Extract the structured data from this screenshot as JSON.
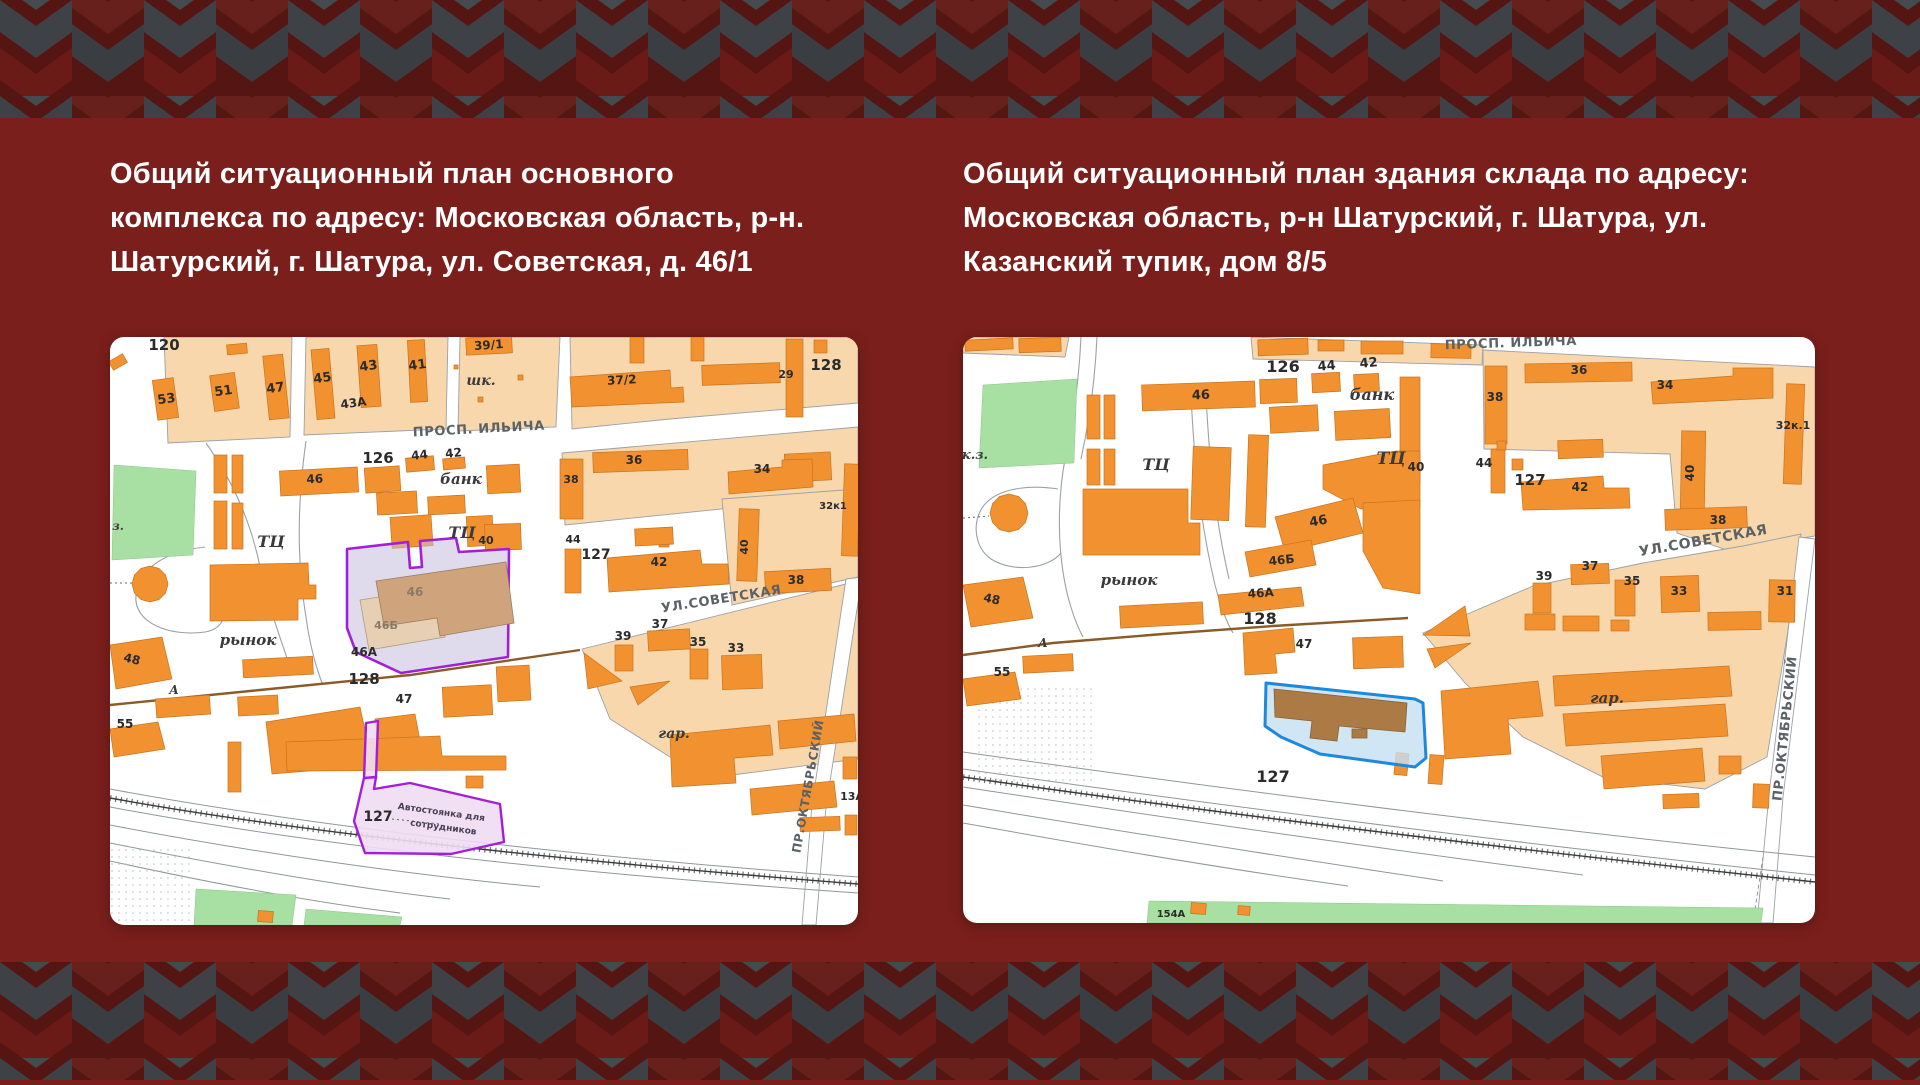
{
  "palette": {
    "page_background": "#7A1F1B",
    "pattern_charcoal": "#3E4247",
    "pattern_dark_red": "#551512",
    "title_color": "#FFFFFF",
    "map_block": "#F8D7AC",
    "map_building": "#F2912F",
    "map_green": "#A7E0A2",
    "highlight_purple": "#A21FD9",
    "highlight_blue": "#1E88DD"
  },
  "left_panel": {
    "title_lines": {
      "0": "Общий ситуационный план основного",
      "1": "комплекса по адресу: Московская область, р-н.",
      "2": "Шатурский, г. Шатура, ул. Советская, д. 46/1"
    },
    "map": {
      "labels": [
        {
          "t": "120",
          "x": 54,
          "y": 13,
          "fs": 15
        },
        {
          "t": "53",
          "x": 57,
          "y": 66,
          "fs": 13,
          "rot": -8
        },
        {
          "t": "51",
          "x": 114,
          "y": 58,
          "fs": 13,
          "rot": -8
        },
        {
          "t": "47",
          "x": 166,
          "y": 55,
          "fs": 13,
          "rot": -8
        },
        {
          "t": "45",
          "x": 213,
          "y": 45,
          "fs": 13,
          "rot": -8
        },
        {
          "t": "43",
          "x": 259,
          "y": 33,
          "fs": 13,
          "rot": -8
        },
        {
          "t": "43А",
          "x": 244,
          "y": 70,
          "fs": 12,
          "rot": -8
        },
        {
          "t": "41",
          "x": 308,
          "y": 32,
          "fs": 13,
          "rot": -8
        },
        {
          "t": "39/1",
          "x": 379,
          "y": 12,
          "fs": 12,
          "rot": -4
        },
        {
          "t": "шк.",
          "x": 371,
          "y": 48,
          "fs": 14,
          "c": "name"
        },
        {
          "t": "37/2",
          "x": 512,
          "y": 47,
          "fs": 12,
          "rot": -3
        },
        {
          "t": "29",
          "x": 676,
          "y": 41,
          "fs": 11
        },
        {
          "t": "128",
          "x": 716,
          "y": 33,
          "fs": 15
        },
        {
          "t": "ПРОСП. ИЛЬИЧА",
          "x": 369,
          "y": 96,
          "fs": 13,
          "c": "street",
          "rot": -3
        },
        {
          "t": "126",
          "x": 268,
          "y": 126,
          "fs": 15
        },
        {
          "t": "44",
          "x": 310,
          "y": 122,
          "fs": 12,
          "rot": -6
        },
        {
          "t": "42",
          "x": 344,
          "y": 120,
          "fs": 12,
          "rot": -6
        },
        {
          "t": "банк",
          "x": 351,
          "y": 147,
          "fs": 15,
          "c": "name"
        },
        {
          "t": "46",
          "x": 205,
          "y": 146,
          "fs": 12,
          "rot": -3
        },
        {
          "t": "з.",
          "x": 8,
          "y": 193,
          "fs": 12,
          "c": "name"
        },
        {
          "t": "ТЦ",
          "x": 161,
          "y": 210,
          "fs": 16,
          "c": "name"
        },
        {
          "t": "ТЦ",
          "x": 352,
          "y": 201,
          "fs": 16,
          "c": "name"
        },
        {
          "t": "40",
          "x": 376,
          "y": 207,
          "fs": 11
        },
        {
          "t": "46",
          "x": 305,
          "y": 259,
          "fs": 12,
          "c": "hl"
        },
        {
          "t": "46Б",
          "x": 276,
          "y": 292,
          "fs": 11,
          "c": "hl"
        },
        {
          "t": "46А",
          "x": 254,
          "y": 319,
          "fs": 12
        },
        {
          "t": "128",
          "x": 254,
          "y": 347,
          "fs": 15
        },
        {
          "t": "рынок",
          "x": 138,
          "y": 308,
          "fs": 15,
          "c": "name"
        },
        {
          "t": "48",
          "x": 21,
          "y": 326,
          "fs": 12,
          "rot": 14
        },
        {
          "t": "А",
          "x": 64,
          "y": 357,
          "fs": 12,
          "c": "name"
        },
        {
          "t": "55",
          "x": 15,
          "y": 391,
          "fs": 12
        },
        {
          "t": "47",
          "x": 294,
          "y": 366,
          "fs": 12
        },
        {
          "t": "38",
          "x": 461,
          "y": 146,
          "fs": 11
        },
        {
          "t": "36",
          "x": 524,
          "y": 127,
          "fs": 12
        },
        {
          "t": "34",
          "x": 652,
          "y": 136,
          "fs": 12
        },
        {
          "t": "32к1",
          "x": 723,
          "y": 172,
          "fs": 10
        },
        {
          "t": "40",
          "x": 638,
          "y": 210,
          "fs": 11,
          "rot": -90
        },
        {
          "t": "44",
          "x": 463,
          "y": 206,
          "fs": 11
        },
        {
          "t": "127",
          "x": 486,
          "y": 222,
          "fs": 14
        },
        {
          "t": "42",
          "x": 549,
          "y": 229,
          "fs": 12
        },
        {
          "t": "38",
          "x": 686,
          "y": 247,
          "fs": 12
        },
        {
          "t": "УЛ.СОВЕТСКАЯ",
          "x": 612,
          "y": 266,
          "fs": 13,
          "c": "street",
          "rot": -9
        },
        {
          "t": "39",
          "x": 513,
          "y": 303,
          "fs": 12
        },
        {
          "t": "37",
          "x": 550,
          "y": 291,
          "fs": 12
        },
        {
          "t": "35",
          "x": 588,
          "y": 309,
          "fs": 12
        },
        {
          "t": "33",
          "x": 626,
          "y": 315,
          "fs": 12
        },
        {
          "t": "гар.",
          "x": 564,
          "y": 401,
          "fs": 14,
          "c": "name"
        },
        {
          "t": "13А",
          "x": 742,
          "y": 463,
          "fs": 11
        },
        {
          "t": "ПР.ОКТЯБРЬСКИЙ",
          "x": 702,
          "y": 450,
          "fs": 12,
          "c": "street",
          "rot": -80
        },
        {
          "t": "127",
          "x": 268,
          "y": 484,
          "fs": 14
        },
        {
          "t": "Автостоянка для",
          "x": 331,
          "y": 478,
          "fs": 9,
          "rot": 8,
          "c": "pk"
        },
        {
          "t": "сотрудников",
          "x": 333,
          "y": 493,
          "fs": 9,
          "rot": 8,
          "c": "pk"
        }
      ]
    }
  },
  "right_panel": {
    "title_lines": {
      "0": "Общий ситуационный план здания склада по адресу:",
      "1": "Московская область, р-н Шатурский, г. Шатура, ул.",
      "2": "Казанский тупик, дом 8/5"
    },
    "map": {
      "labels": [
        {
          "t": "к.з.",
          "x": 12,
          "y": 122,
          "fs": 13,
          "c": "name"
        },
        {
          "t": "126",
          "x": 320,
          "y": 35,
          "fs": 16
        },
        {
          "t": "44",
          "x": 364,
          "y": 33,
          "fs": 13,
          "rot": -5
        },
        {
          "t": "42",
          "x": 406,
          "y": 30,
          "fs": 13,
          "rot": -5
        },
        {
          "t": "банк",
          "x": 409,
          "y": 63,
          "fs": 16,
          "c": "name"
        },
        {
          "t": "46",
          "x": 238,
          "y": 62,
          "fs": 13,
          "rot": -2
        },
        {
          "t": "ТЦ",
          "x": 193,
          "y": 133,
          "fs": 16,
          "c": "name"
        },
        {
          "t": "ТЦ",
          "x": 428,
          "y": 127,
          "fs": 17,
          "c": "name"
        },
        {
          "t": "40",
          "x": 453,
          "y": 134,
          "fs": 12
        },
        {
          "t": "рынок",
          "x": 166,
          "y": 248,
          "fs": 15,
          "c": "name"
        },
        {
          "t": "46",
          "x": 356,
          "y": 188,
          "fs": 13,
          "rot": -10
        },
        {
          "t": "46Б",
          "x": 319,
          "y": 227,
          "fs": 12,
          "rot": -6
        },
        {
          "t": "46А",
          "x": 298,
          "y": 260,
          "fs": 12,
          "rot": -4
        },
        {
          "t": "128",
          "x": 297,
          "y": 287,
          "fs": 16
        },
        {
          "t": "48",
          "x": 28,
          "y": 266,
          "fs": 12,
          "rot": 12
        },
        {
          "t": "А",
          "x": 80,
          "y": 310,
          "fs": 12,
          "c": "name"
        },
        {
          "t": "55",
          "x": 39,
          "y": 339,
          "fs": 12
        },
        {
          "t": "47",
          "x": 341,
          "y": 311,
          "fs": 12
        },
        {
          "t": "127",
          "x": 310,
          "y": 445,
          "fs": 16
        },
        {
          "t": "ПРОСП. ИЛЬИЧА",
          "x": 548,
          "y": 10,
          "fs": 13,
          "c": "street",
          "rot": -2
        },
        {
          "t": "38",
          "x": 532,
          "y": 64,
          "fs": 12
        },
        {
          "t": "36",
          "x": 616,
          "y": 37,
          "fs": 12
        },
        {
          "t": "34",
          "x": 702,
          "y": 52,
          "fs": 12
        },
        {
          "t": "32к.1",
          "x": 830,
          "y": 92,
          "fs": 11
        },
        {
          "t": "44",
          "x": 521,
          "y": 130,
          "fs": 12
        },
        {
          "t": "127",
          "x": 567,
          "y": 148,
          "fs": 15
        },
        {
          "t": "42",
          "x": 617,
          "y": 154,
          "fs": 12
        },
        {
          "t": "40",
          "x": 731,
          "y": 136,
          "fs": 12,
          "rot": -90
        },
        {
          "t": "38",
          "x": 755,
          "y": 187,
          "fs": 12
        },
        {
          "t": "УЛ.СОВЕТСКАЯ",
          "x": 741,
          "y": 208,
          "fs": 14,
          "c": "street",
          "rot": -10
        },
        {
          "t": "39",
          "x": 581,
          "y": 243,
          "fs": 12
        },
        {
          "t": "37",
          "x": 627,
          "y": 233,
          "fs": 12
        },
        {
          "t": "35",
          "x": 669,
          "y": 248,
          "fs": 12
        },
        {
          "t": "33",
          "x": 716,
          "y": 258,
          "fs": 12
        },
        {
          "t": "31",
          "x": 822,
          "y": 258,
          "fs": 12
        },
        {
          "t": "гар.",
          "x": 644,
          "y": 366,
          "fs": 15,
          "c": "name"
        },
        {
          "t": "ПР.ОКТЯБРЬСКИЙ",
          "x": 826,
          "y": 392,
          "fs": 13,
          "c": "street",
          "rot": -84
        },
        {
          "t": "154А",
          "x": 208,
          "y": 580,
          "fs": 10
        }
      ]
    }
  }
}
